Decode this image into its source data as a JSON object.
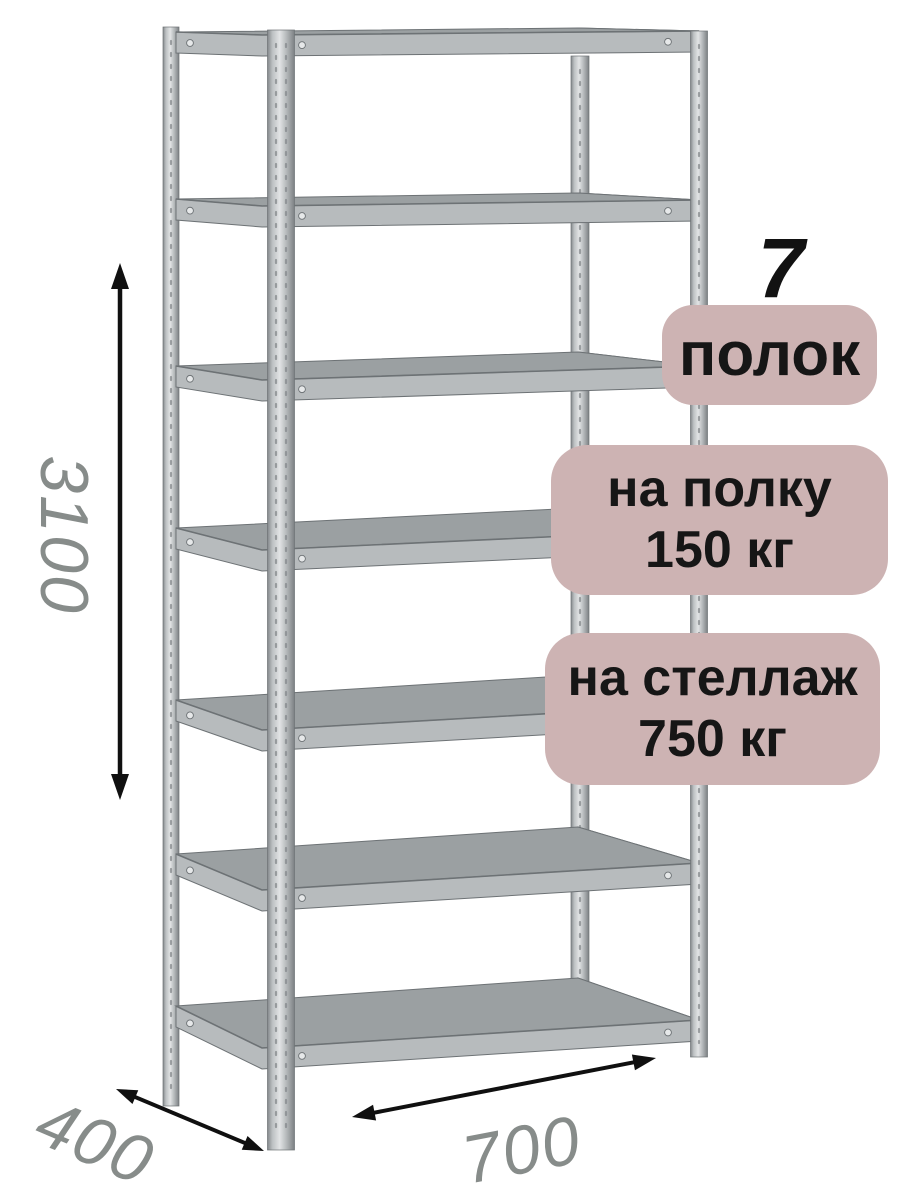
{
  "badges": {
    "count_number": "7",
    "count_label": "полок",
    "per_shelf_line1": "на полку",
    "per_shelf_line2": "150 кг",
    "per_rack_line1": "на стеллаж",
    "per_rack_line2": "750 кг"
  },
  "dimensions": {
    "height": "3100",
    "depth": "400",
    "width": "700"
  },
  "rack": {
    "shelf_count": 7
  },
  "colors": {
    "badge_bg": "#cdb3b3",
    "badge_text": "#161616",
    "dim_text": "#878c8a",
    "arrow": "#101010",
    "deck_top": "#9ba0a2",
    "band": "#b7bbbd",
    "edge": "#6d7275",
    "post_dark": "#85898c",
    "post_light": "#dfe2e3",
    "bolt": "#e6e8e9"
  }
}
